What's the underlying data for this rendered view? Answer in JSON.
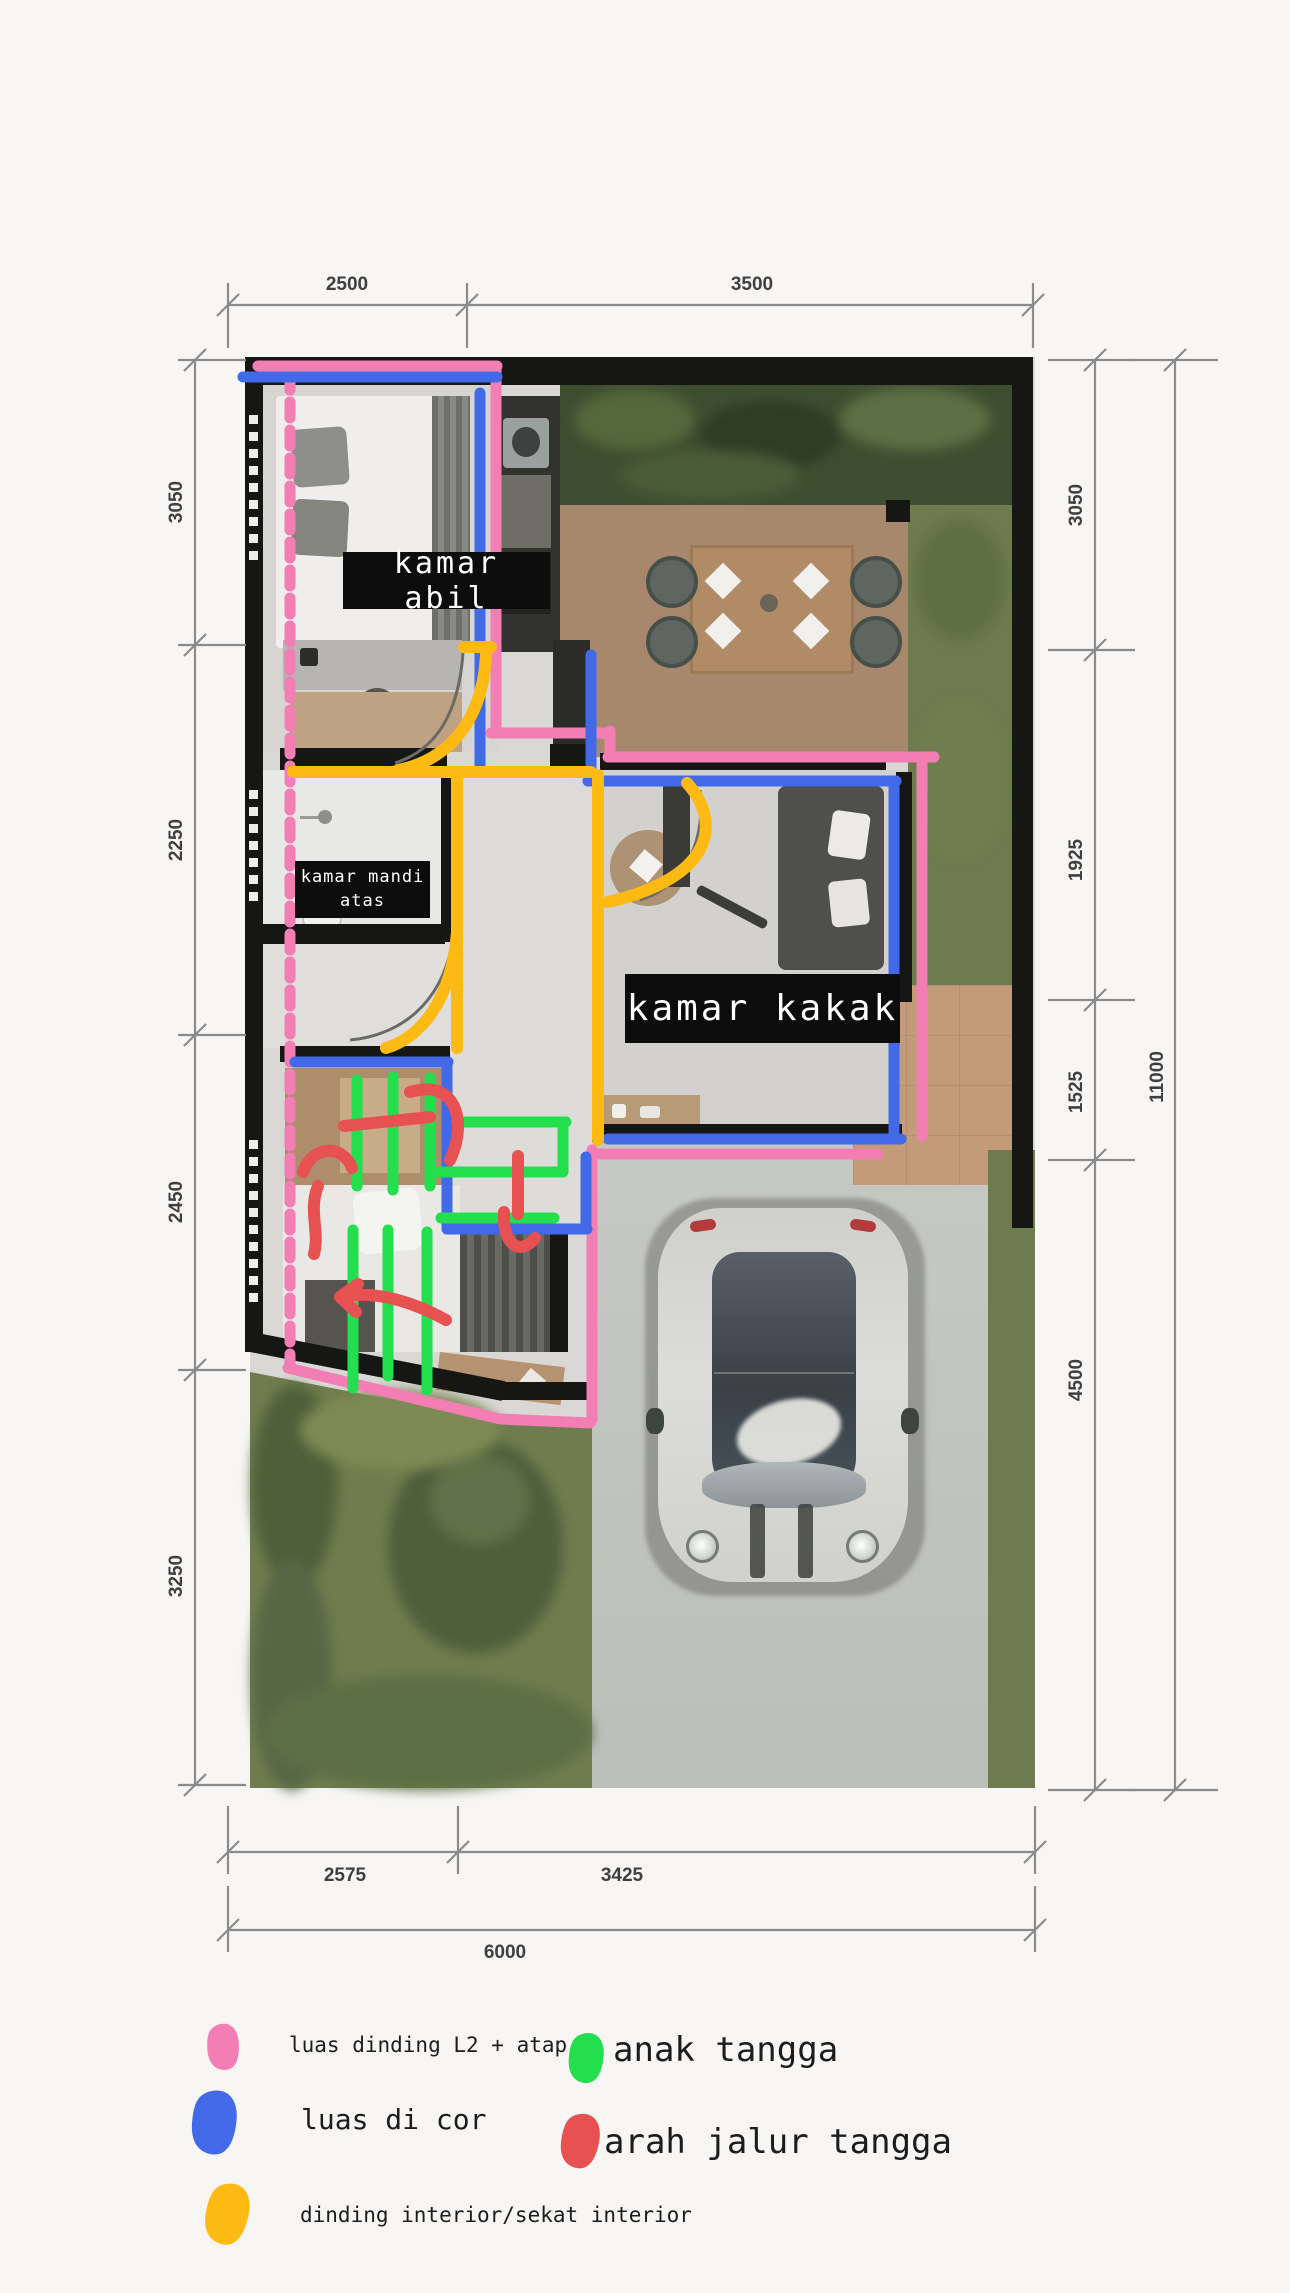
{
  "plan": {
    "room_labels": {
      "kamar_abil": "kamar abil",
      "kamar_mandi_line1": "kamar mandi",
      "kamar_mandi_line2": "atas",
      "kamar_kakak": "kamar kakak"
    },
    "dimensions": {
      "top": [
        "2500",
        "3500"
      ],
      "left": [
        "3050",
        "2250",
        "2450",
        "3250"
      ],
      "right": [
        "3050",
        "1925",
        "1525",
        "4500"
      ],
      "right_total": "11000",
      "bottom": [
        "2575",
        "3425"
      ],
      "bottom_total": "6000"
    }
  },
  "colors": {
    "pink": "#f27eb4",
    "blue": "#4169e8",
    "yellow": "#fcba12",
    "green": "#23df4d",
    "red": "#e85151",
    "label_box": "#0c0c0c",
    "label_text": "#ffffff",
    "dimension": "#8b8b8b"
  },
  "legend": {
    "items": [
      {
        "color": "pink",
        "label": "luas dinding L2 + atap"
      },
      {
        "color": "blue",
        "label": "luas di cor"
      },
      {
        "color": "yellow",
        "label": "dinding interior/sekat interior"
      },
      {
        "color": "green",
        "label": "anak tangga"
      },
      {
        "color": "red",
        "label": "arah jalur tangga"
      }
    ]
  }
}
